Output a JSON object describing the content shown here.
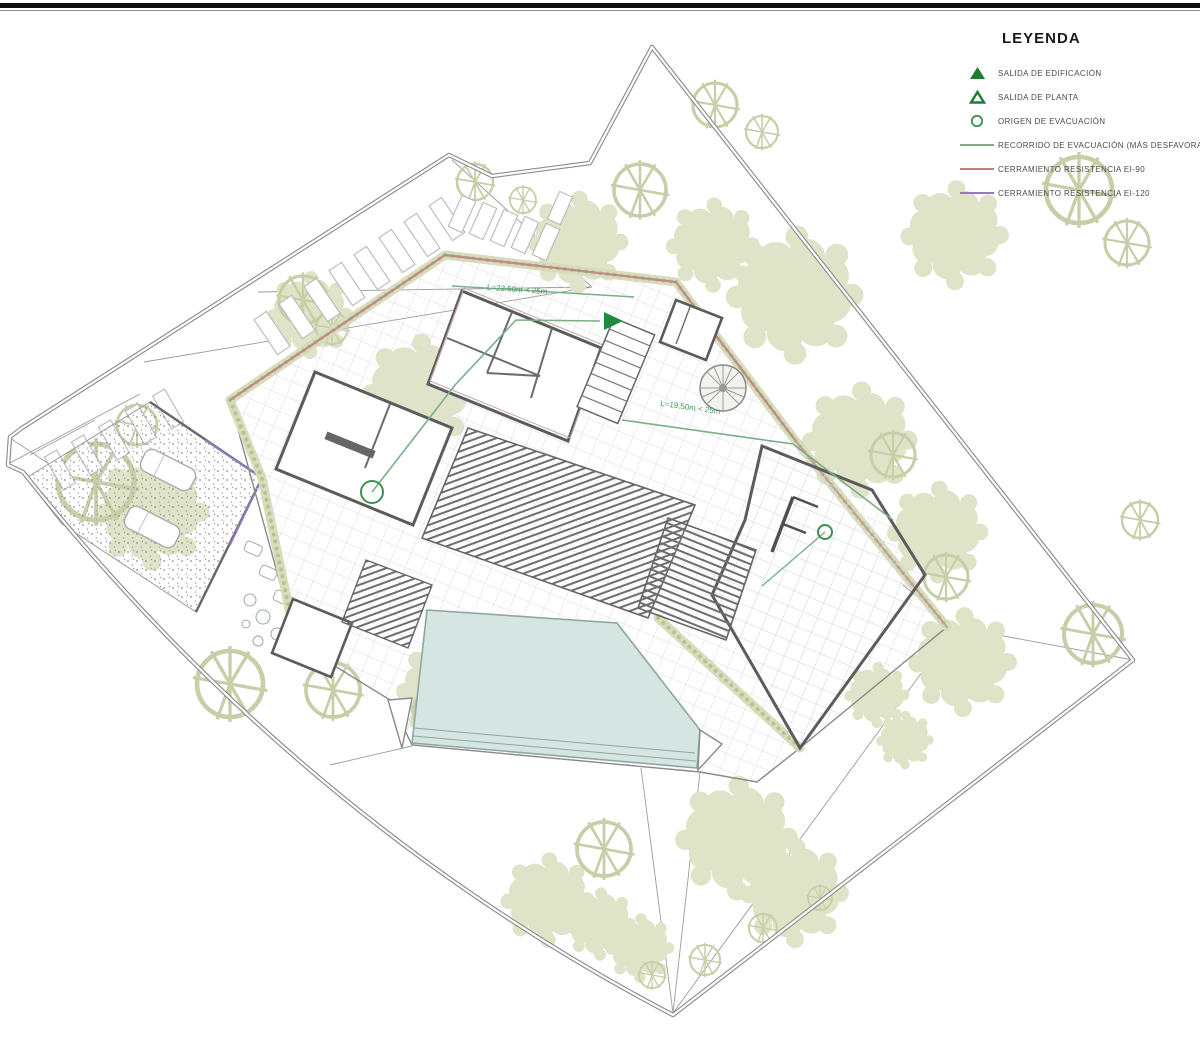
{
  "page": {
    "background": "#ffffff",
    "top_border_color": "#0d0d0d"
  },
  "legend": {
    "title": "LEYENDA",
    "items": [
      {
        "symbol": "triangle-filled",
        "label": "SALIDA DE EDIFICACIÓN",
        "color": "#1e7d32"
      },
      {
        "symbol": "triangle-open",
        "label": "SALIDA DE PLANTA",
        "color": "#1e7d32"
      },
      {
        "symbol": "circle-open",
        "label": "ORIGEN DE EVACUACIÓN",
        "color": "#3d8f55"
      },
      {
        "symbol": "line",
        "label": "RECORRIDO DE EVACUACIÓN (MÁS DESFAVORABLE",
        "color": "#84a98b"
      },
      {
        "symbol": "line",
        "label": "CERRAMIENTO RESISTENCIA EI-90",
        "color": "#c17d75"
      },
      {
        "symbol": "line",
        "label": "CERRAMIENTO RESISTENCIA EI-120",
        "color": "#9579c9"
      }
    ]
  },
  "plan": {
    "annotations": [
      {
        "text": "L=23.50m < 25m"
      },
      {
        "text": "L=19.50m < 25m"
      }
    ],
    "colors": {
      "exit_green": "#1e8c3c",
      "route_green": "#7cae87",
      "annotation_green": "#43a05e",
      "ei90_red": "#c08a86",
      "ei120_purple": "#9579c9",
      "pool_fill": "#d5e5e1",
      "vegetation": "#dfe4c8",
      "hedge": "#d6ddbb",
      "walls_dark": "#5c5c5c",
      "boundary_gray": "#8d8d8d"
    }
  }
}
